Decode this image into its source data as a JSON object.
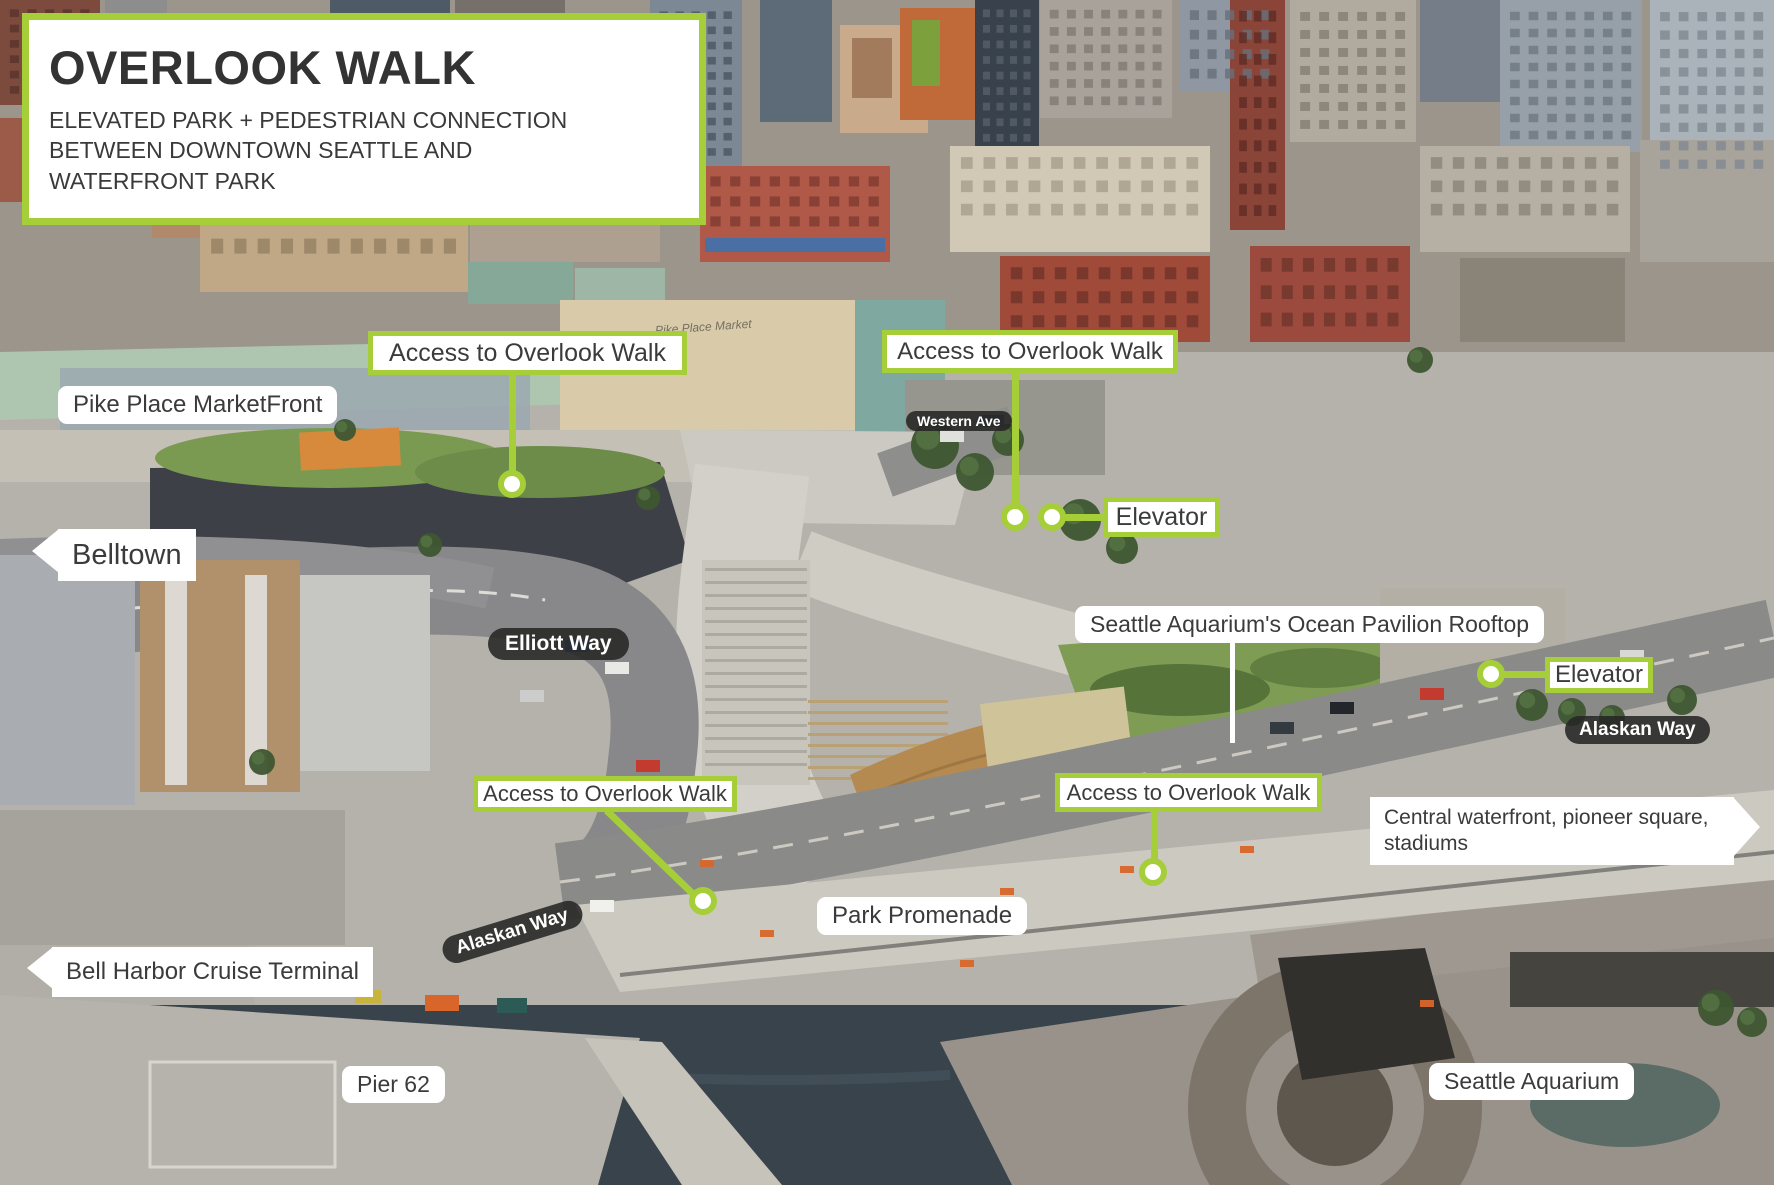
{
  "title_card": {
    "title": "OVERLOOK WALK",
    "subtitle": "ELEVATED PARK + PEDESTRIAN CONNECTION BETWEEN DOWNTOWN SEATTLE AND WATERFRONT PARK"
  },
  "labels": {
    "access_top_left": "Access to Overlook Walk",
    "access_top_right": "Access to Overlook Walk",
    "access_bottom_left": "Access to Overlook Walk",
    "access_bottom_right": "Access to Overlook Walk",
    "elevator_west": "Elevator",
    "elevator_east": "Elevator",
    "pike_place_marketfront": "Pike Place MarketFront",
    "belltown": "Belltown",
    "western_ave": "Western Ave",
    "elliott_way": "Elliott Way",
    "ocean_pavilion_rooftop": "Seattle Aquarium's Ocean Pavilion Rooftop",
    "alaskan_way_north": "Alaskan Way",
    "alaskan_way_south": "Alaskan Way",
    "central_waterfront": "Central waterfront, pioneer square, stadiums",
    "park_promenade": "Park Promenade",
    "bell_harbor_cruise_terminal": "Bell Harbor Cruise Terminal",
    "pier_62": "Pier 62",
    "seattle_aquarium": "Seattle Aquarium"
  },
  "photo_texts": {
    "pike_place_market_wall_sign": "Pike Place Market"
  },
  "colors": {
    "accent_green": "#A6CE39",
    "label_text": "#3B3B3B",
    "dark_pill_bg": "#2B2B2B",
    "water": "#39434B",
    "leader_white": "#FFFFFF"
  }
}
